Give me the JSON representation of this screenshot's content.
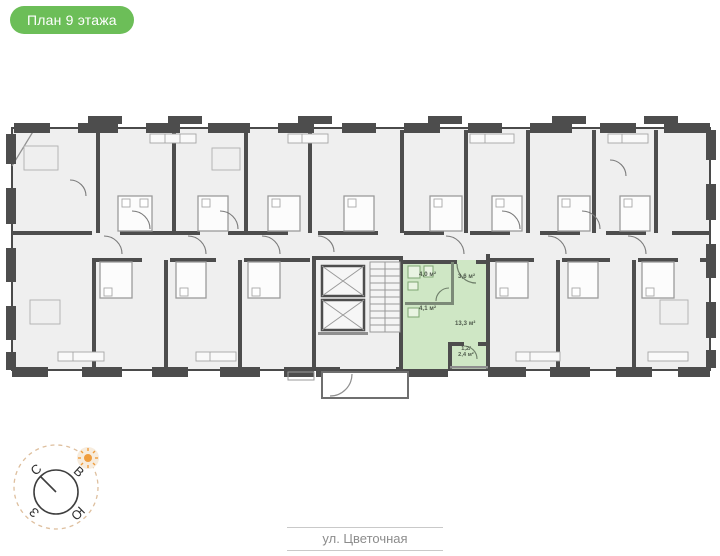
{
  "badge": {
    "label": "План 9 этажа"
  },
  "theme": {
    "badge_green": "#6cbe58",
    "highlight_green": "#cfe7c5",
    "wall_color": "#4d4d4d",
    "room_fill": "#efefef"
  },
  "plan": {
    "floor": "9",
    "apartment": {
      "rooms": {
        "bathroom": {
          "area": "4,0 м²"
        },
        "hall": {
          "area": "3,6 м²"
        },
        "kitchen": {
          "area": "4,1 м²"
        },
        "living": {
          "area": "13,3 м²"
        },
        "balcony": {
          "area_reduced": "1,2/",
          "area_full": "2,4 м²"
        }
      }
    }
  },
  "compass": {
    "letters": {
      "n": "С",
      "e": "В",
      "w": "З",
      "s": "Ю"
    }
  },
  "street": {
    "name": "ул. Цветочная"
  }
}
